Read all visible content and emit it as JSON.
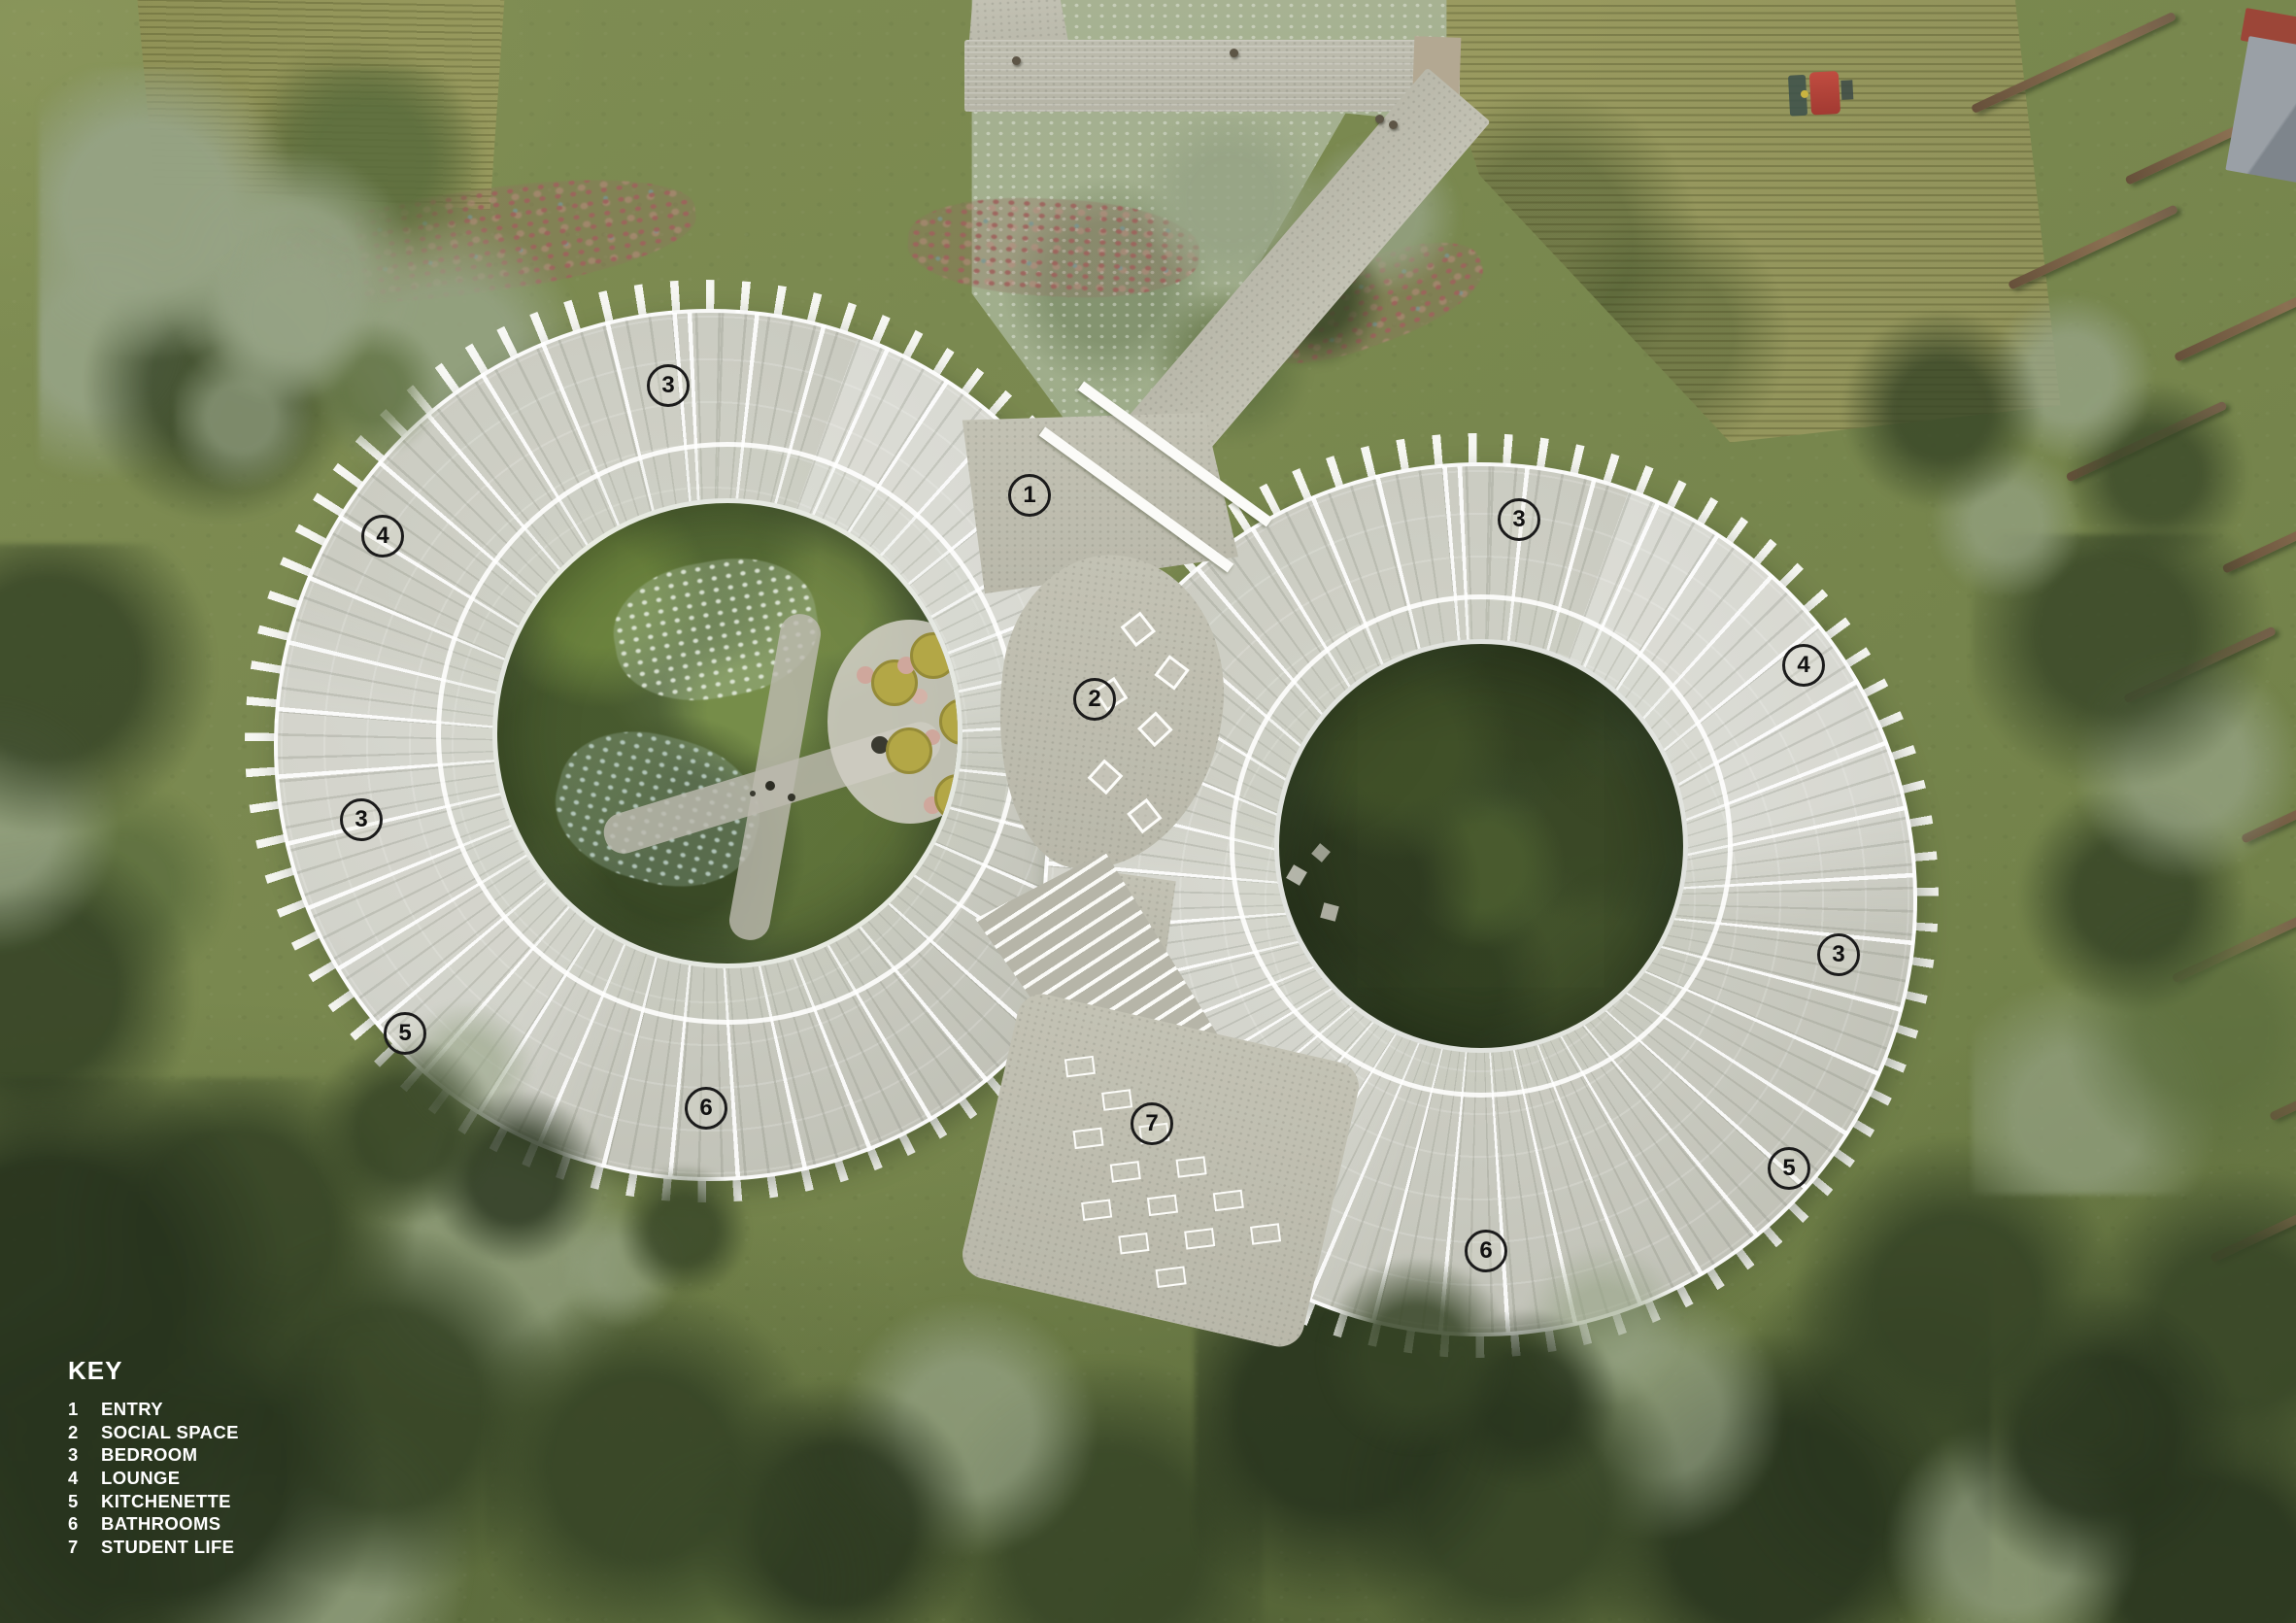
{
  "legend": {
    "title": "KEY",
    "items": [
      {
        "num": "1",
        "label": "ENTRY"
      },
      {
        "num": "2",
        "label": "SOCIAL SPACE"
      },
      {
        "num": "3",
        "label": "BEDROOM"
      },
      {
        "num": "4",
        "label": "LOUNGE"
      },
      {
        "num": "5",
        "label": "KITCHENETTE"
      },
      {
        "num": "6",
        "label": "BATHROOMS"
      },
      {
        "num": "7",
        "label": "STUDENT LIFE"
      }
    ]
  },
  "markers": [
    {
      "label": "1"
    },
    {
      "label": "2"
    },
    {
      "label": "3"
    },
    {
      "label": "4"
    },
    {
      "label": "3"
    },
    {
      "label": "5"
    },
    {
      "label": "6"
    },
    {
      "label": "7"
    },
    {
      "label": "3"
    },
    {
      "label": "4"
    },
    {
      "label": "3"
    },
    {
      "label": "5"
    },
    {
      "label": "6"
    }
  ],
  "colors": {
    "legend_text": "#ffffff",
    "marker_ring": "#1b1b1b",
    "lawn_green": "#78874e",
    "tree_dark": "#364426",
    "tree_sage": "#96a385",
    "concrete_ring": "#c9cabf",
    "path_stone": "#b9b8aa",
    "crop_field": "#95965c",
    "flower_pink": "#9e625c",
    "table_yellow": "#b3a746",
    "tractor_red": "#b2423a",
    "roof_gray": "#8a9096"
  }
}
